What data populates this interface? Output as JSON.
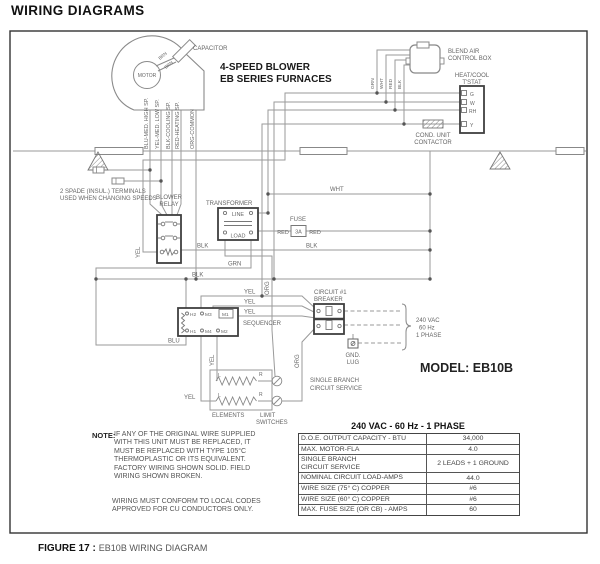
{
  "colors": {
    "wire": "#9a9a9a",
    "component_border": "#3f3f3f",
    "label_text": "#666666",
    "title_text": "#111111"
  },
  "page": {
    "title": "WIRING DIAGRAMS",
    "figure_label": "FIGURE 17 :",
    "figure_title": "EB10B WIRING DIAGRAM"
  },
  "diagram": {
    "heading1": "4-SPEED BLOWER",
    "heading2": "EB SERIES FURNACES",
    "model": "MODEL: EB10B",
    "motor": "MOTOR",
    "capacitor": "CAPACITOR",
    "blend_air1": "BLEND AIR",
    "blend_air2": "CONTROL BOX",
    "tstat1": "HEAT/COOL",
    "tstat2": "T'STAT",
    "tstat_g": "G",
    "tstat_w": "W",
    "tstat_rh": "RH",
    "tstat_y": "Y",
    "contactor1": "COND. UNIT",
    "contactor2": "CONTACTOR",
    "spade1": "2 SPADE (INSUL.) TERMINALS",
    "spade2": "USED WHEN CHANGING SPEEDS",
    "relay1": "BLOWER",
    "relay2": "RELAY",
    "transformer": "TRANSFORMER",
    "line_lbl": "LINE",
    "load_lbl": "LOAD",
    "fuse": "FUSE",
    "fuse_rating": "3A",
    "sequencer": "SEQUENCER",
    "seq_h2": "H2",
    "seq_m3": "M3",
    "seq_m1": "M1",
    "seq_h1": "H1",
    "seq_m4": "M4",
    "seq_m2": "M2",
    "breaker1": "CIRCUIT #1",
    "breaker2": "BREAKER",
    "supply1": "240 VAC",
    "supply2": "60 Hz",
    "supply3": "1 PHASE",
    "gnd1": "GND.",
    "gnd2": "LUG",
    "branch1": "SINGLE BRANCH",
    "branch2": "CIRCUIT SERVICE",
    "elements": "ELEMENTS",
    "limit1": "LIMIT",
    "limit2": "SWITCHES",
    "elem_l": "L",
    "elem_r": "R",
    "leads": [
      "BLU-MED. HIGH SP.",
      "YEL-MED. LOW SP.",
      "BLK-COOLING SP.",
      "RED-HEATING SP.",
      "ORG-COMMON"
    ],
    "wire": {
      "wht": "WHT",
      "grn": "GRN",
      "red": "RED",
      "blk": "BLK",
      "yel": "YEL",
      "org": "ORG",
      "blu": "BLU",
      "brn": "BRN"
    }
  },
  "note": {
    "label": "NOTE:",
    "lines": [
      "IF ANY OF THE ORIGINAL WIRE SUPPLIED",
      "WITH THIS UNIT MUST BE REPLACED, IT",
      "MUST BE REPLACED WITH TYPE 105°C",
      "THERMOPLASTIC OR ITS EQUIVALENT.",
      "FACTORY WIRING SHOWN SOLID. FIELD",
      "WIRING SHOWN BROKEN."
    ],
    "lines2": [
      "WIRING MUST CONFORM TO LOCAL CODES",
      "APPROVED FOR CU CONDUCTORS ONLY."
    ]
  },
  "table": {
    "header": "240 VAC - 60 Hz - 1 PHASE",
    "rows": [
      {
        "label": "D.O.E. OUTPUT CAPACITY - BTU",
        "value": "34,000"
      },
      {
        "label": "MAX. MOTOR-FLA",
        "value": "4.0"
      },
      {
        "label": "SINGLE BRANCH\nCIRCUIT SERVICE",
        "value": "2 LEADS + 1 GROUND"
      },
      {
        "label": "NOMINAL CIRCUIT LOAD-AMPS",
        "value": "44.0"
      },
      {
        "label": "WIRE SIZE (75° C) COPPER",
        "value": "#6"
      },
      {
        "label": "WIRE SIZE (60° C) COPPER",
        "value": "#6"
      },
      {
        "label": "MAX. FUSE SIZE (OR CB) - AMPS",
        "value": "60"
      }
    ]
  }
}
